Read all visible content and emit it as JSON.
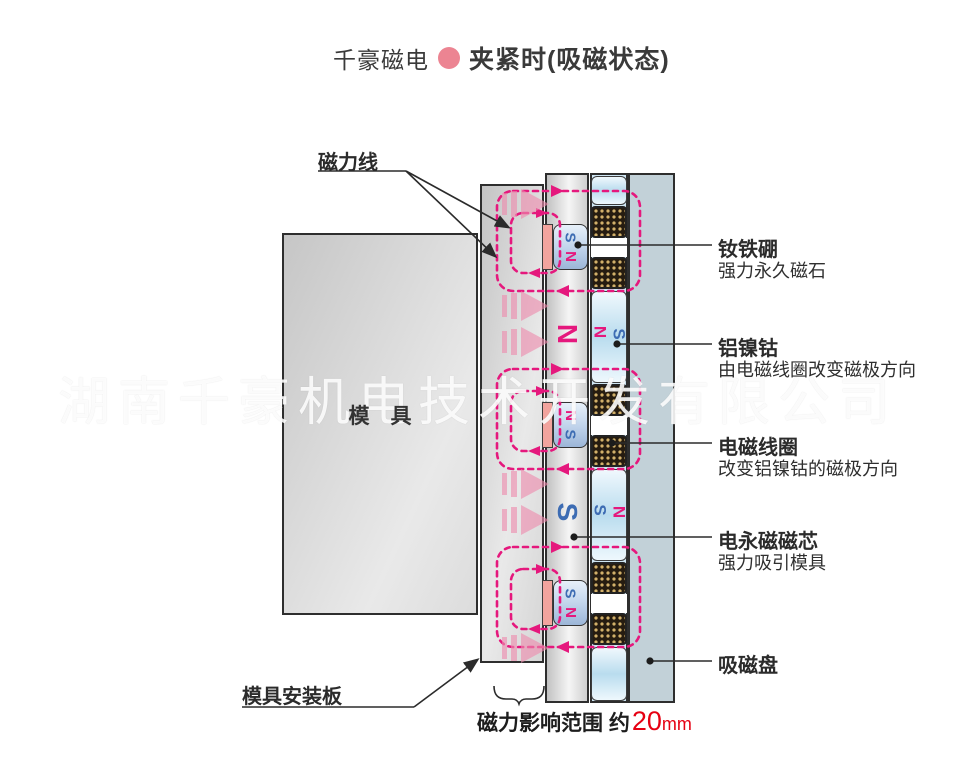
{
  "title": {
    "brand": "千豪磁电",
    "heading": "夹紧时(吸磁状态)"
  },
  "watermark": "湖南千豪机电技术开发有限公司",
  "labels": {
    "field_lines": "磁力线",
    "mold": "模　具",
    "mounting_plate": "模具安装板",
    "range_prefix": "磁力影响范围 约",
    "range_value": "20",
    "range_unit": "mm"
  },
  "callouts": [
    {
      "title": "钕铁硼",
      "desc": "强力永久磁石"
    },
    {
      "title": "铝镍钴",
      "desc": "由电磁线圈改变磁极方向"
    },
    {
      "title": "电磁线圈",
      "desc": "改变铝镍钴的磁极方向"
    },
    {
      "title": "电永磁磁芯",
      "desc": "强力吸引模具"
    },
    {
      "title": "吸磁盘",
      "desc": ""
    }
  ],
  "pole_rows": [
    {
      "top": "S",
      "bottom": "N"
    },
    {
      "top": "N",
      "bottom": "S"
    },
    {
      "top": "S",
      "bottom": "N"
    }
  ],
  "gap_labels": [
    {
      "core": "N",
      "alnico_left": "N",
      "alnico_right": "S"
    },
    {
      "core": "S",
      "alnico_left": "S",
      "alnico_right": "N"
    }
  ],
  "colors": {
    "accent_magenta": "#e5187d",
    "n_pole": "#e5187d",
    "s_pole": "#3d6cb3",
    "brand_dot": "#ec8492",
    "range_red": "#e60012"
  }
}
